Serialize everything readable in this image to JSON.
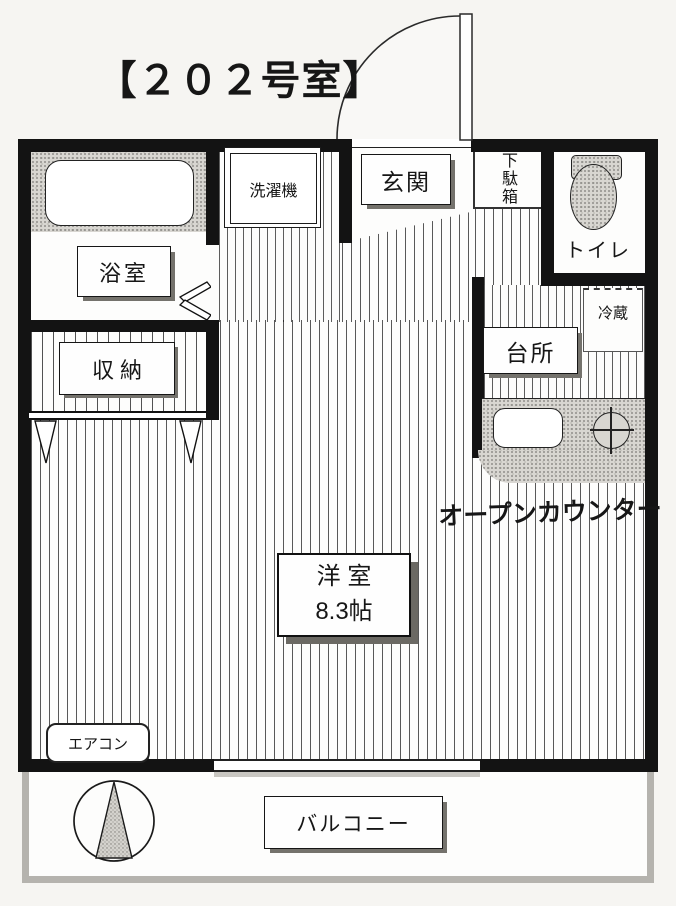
{
  "title": "【２０２号室】",
  "rooms": {
    "bathroom": {
      "label": "浴室"
    },
    "washing_machine": {
      "label": "洗濯機"
    },
    "entrance": {
      "label": "玄関"
    },
    "shoe_box": {
      "label": "下駄箱"
    },
    "toilet": {
      "label": "トイレ"
    },
    "closet": {
      "label": "収 納"
    },
    "kitchen": {
      "label": "台所"
    },
    "refrigerator": {
      "label": "冷蔵"
    },
    "open_counter": {
      "label": "オープンカウンター"
    },
    "western_room": {
      "label": "洋 室",
      "size": "8.3帖"
    },
    "air_conditioner": {
      "label": "エアコン"
    },
    "balcony": {
      "label": "バルコニー"
    }
  },
  "symbols": {
    "door_swing": "entrance-door-swing-arc",
    "folding_door": "bathroom-folding-door",
    "hangers": "closet-hanger-marks",
    "north": "compass-north-cone"
  },
  "colors": {
    "line": "#161616",
    "counter_fill": "#d8d6d1",
    "box_shadow": "#74726c",
    "balcony_border": "#b5b3ae"
  }
}
